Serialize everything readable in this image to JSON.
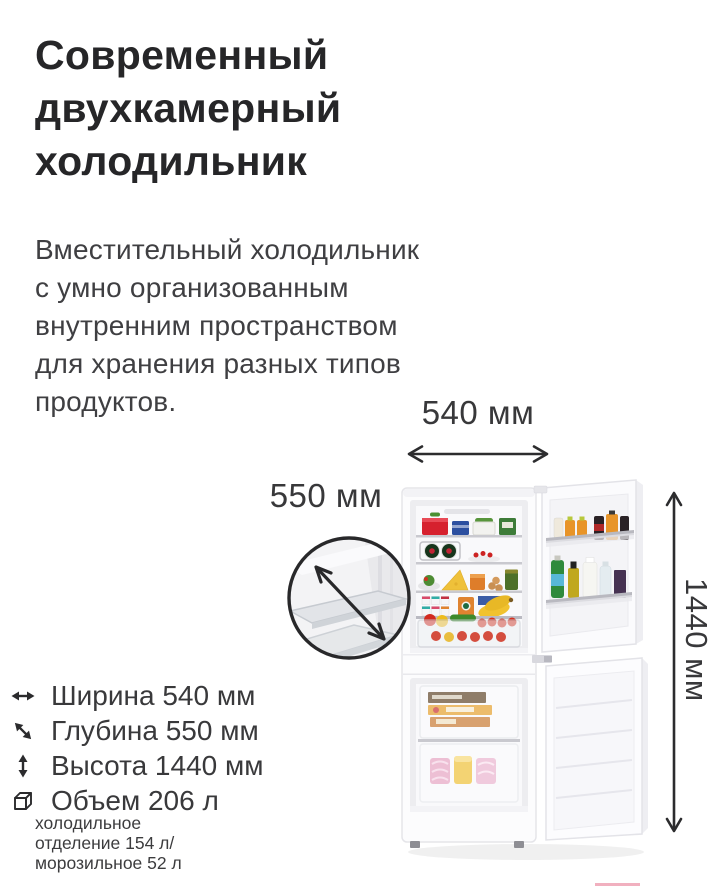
{
  "title": {
    "text": "Современный\nдвухкамерный\nхолодильник"
  },
  "description": {
    "text": "Вместительный холодильник\nс умно организованным\nвнутренним пространством\nдля хранения разных типов\nпродуктов."
  },
  "dimensions": {
    "width_label": "540 мм",
    "depth_label": "550 мм",
    "height_label": "1440 мм"
  },
  "specs": {
    "items": [
      {
        "icon": "width-arrow-icon",
        "label": "Ширина 540 мм"
      },
      {
        "icon": "depth-arrow-icon",
        "label": "Глубина 550 мм"
      },
      {
        "icon": "height-arrow-icon",
        "label": "Высота 1440 мм"
      },
      {
        "icon": "volume-cube-icon",
        "label": "Объем 206 л"
      }
    ],
    "note": "холодильное\nотделение 154 л/\nморозильное 52 л"
  },
  "colors": {
    "title_text": "#262628",
    "body_text": "#3f3f42",
    "arrow": "#2c2c2e",
    "accent_pink_line": "#f1b0bf",
    "fridge_body": "#fcfcfd"
  }
}
